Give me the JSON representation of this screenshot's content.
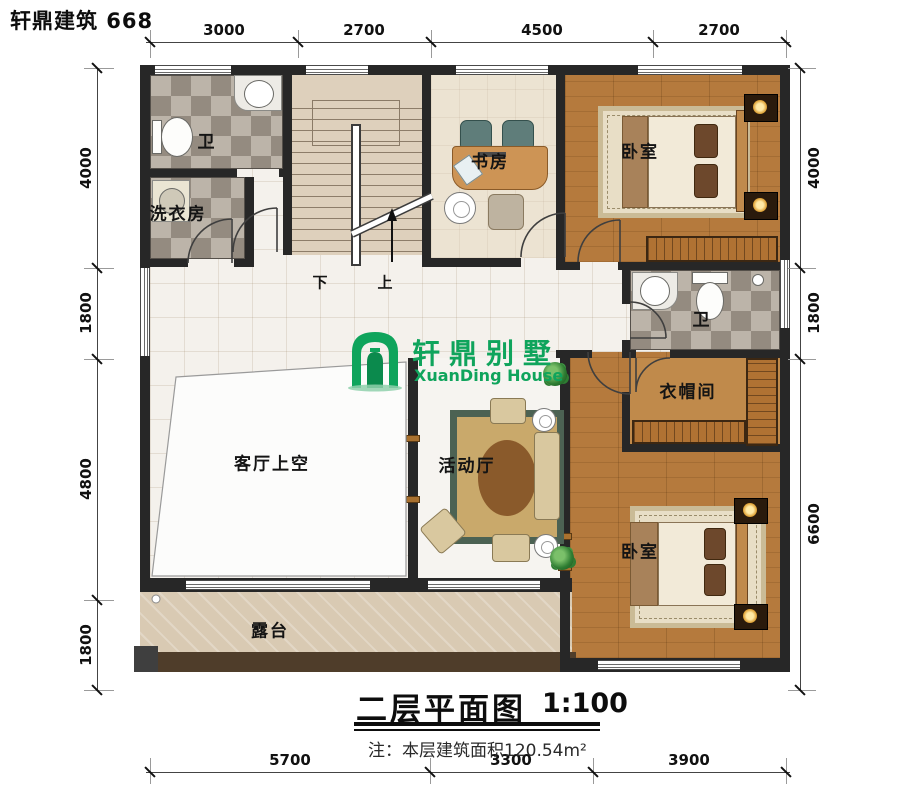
{
  "brand": "轩鼎建筑 668",
  "logo": {
    "cn": "轩鼎别墅",
    "en": "XuanDing House",
    "color": "#0fa45c"
  },
  "rooms": {
    "bath_top": "卫",
    "laundry": "洗衣房",
    "study": "书房",
    "bedroom_top": "卧室",
    "bath_mid": "卫",
    "cloakroom": "衣帽间",
    "living_void": "客厅上空",
    "activity_hall": "活动厅",
    "bedroom_bottom": "卧室",
    "terrace": "露台"
  },
  "stair": {
    "down": "下",
    "up": "上"
  },
  "dimensions": {
    "top": [
      "3000",
      "2700",
      "4500",
      "2700"
    ],
    "bottom": [
      "5700",
      "3300",
      "3900"
    ],
    "left": [
      "4000",
      "1800",
      "4800",
      "1800"
    ],
    "right": [
      "4000",
      "1800",
      "6600"
    ]
  },
  "title": {
    "text": "二层平面图",
    "scale": "1:100"
  },
  "note": "注：本层建筑面积120.54m²",
  "colors": {
    "wall": "#272727",
    "logo_green": "#0fa45c",
    "wood_floor": "#b57a3d",
    "tile_dark": "#948b80",
    "tile_light": "#bcb4a9",
    "terrace_floor": "#d9cab3"
  }
}
